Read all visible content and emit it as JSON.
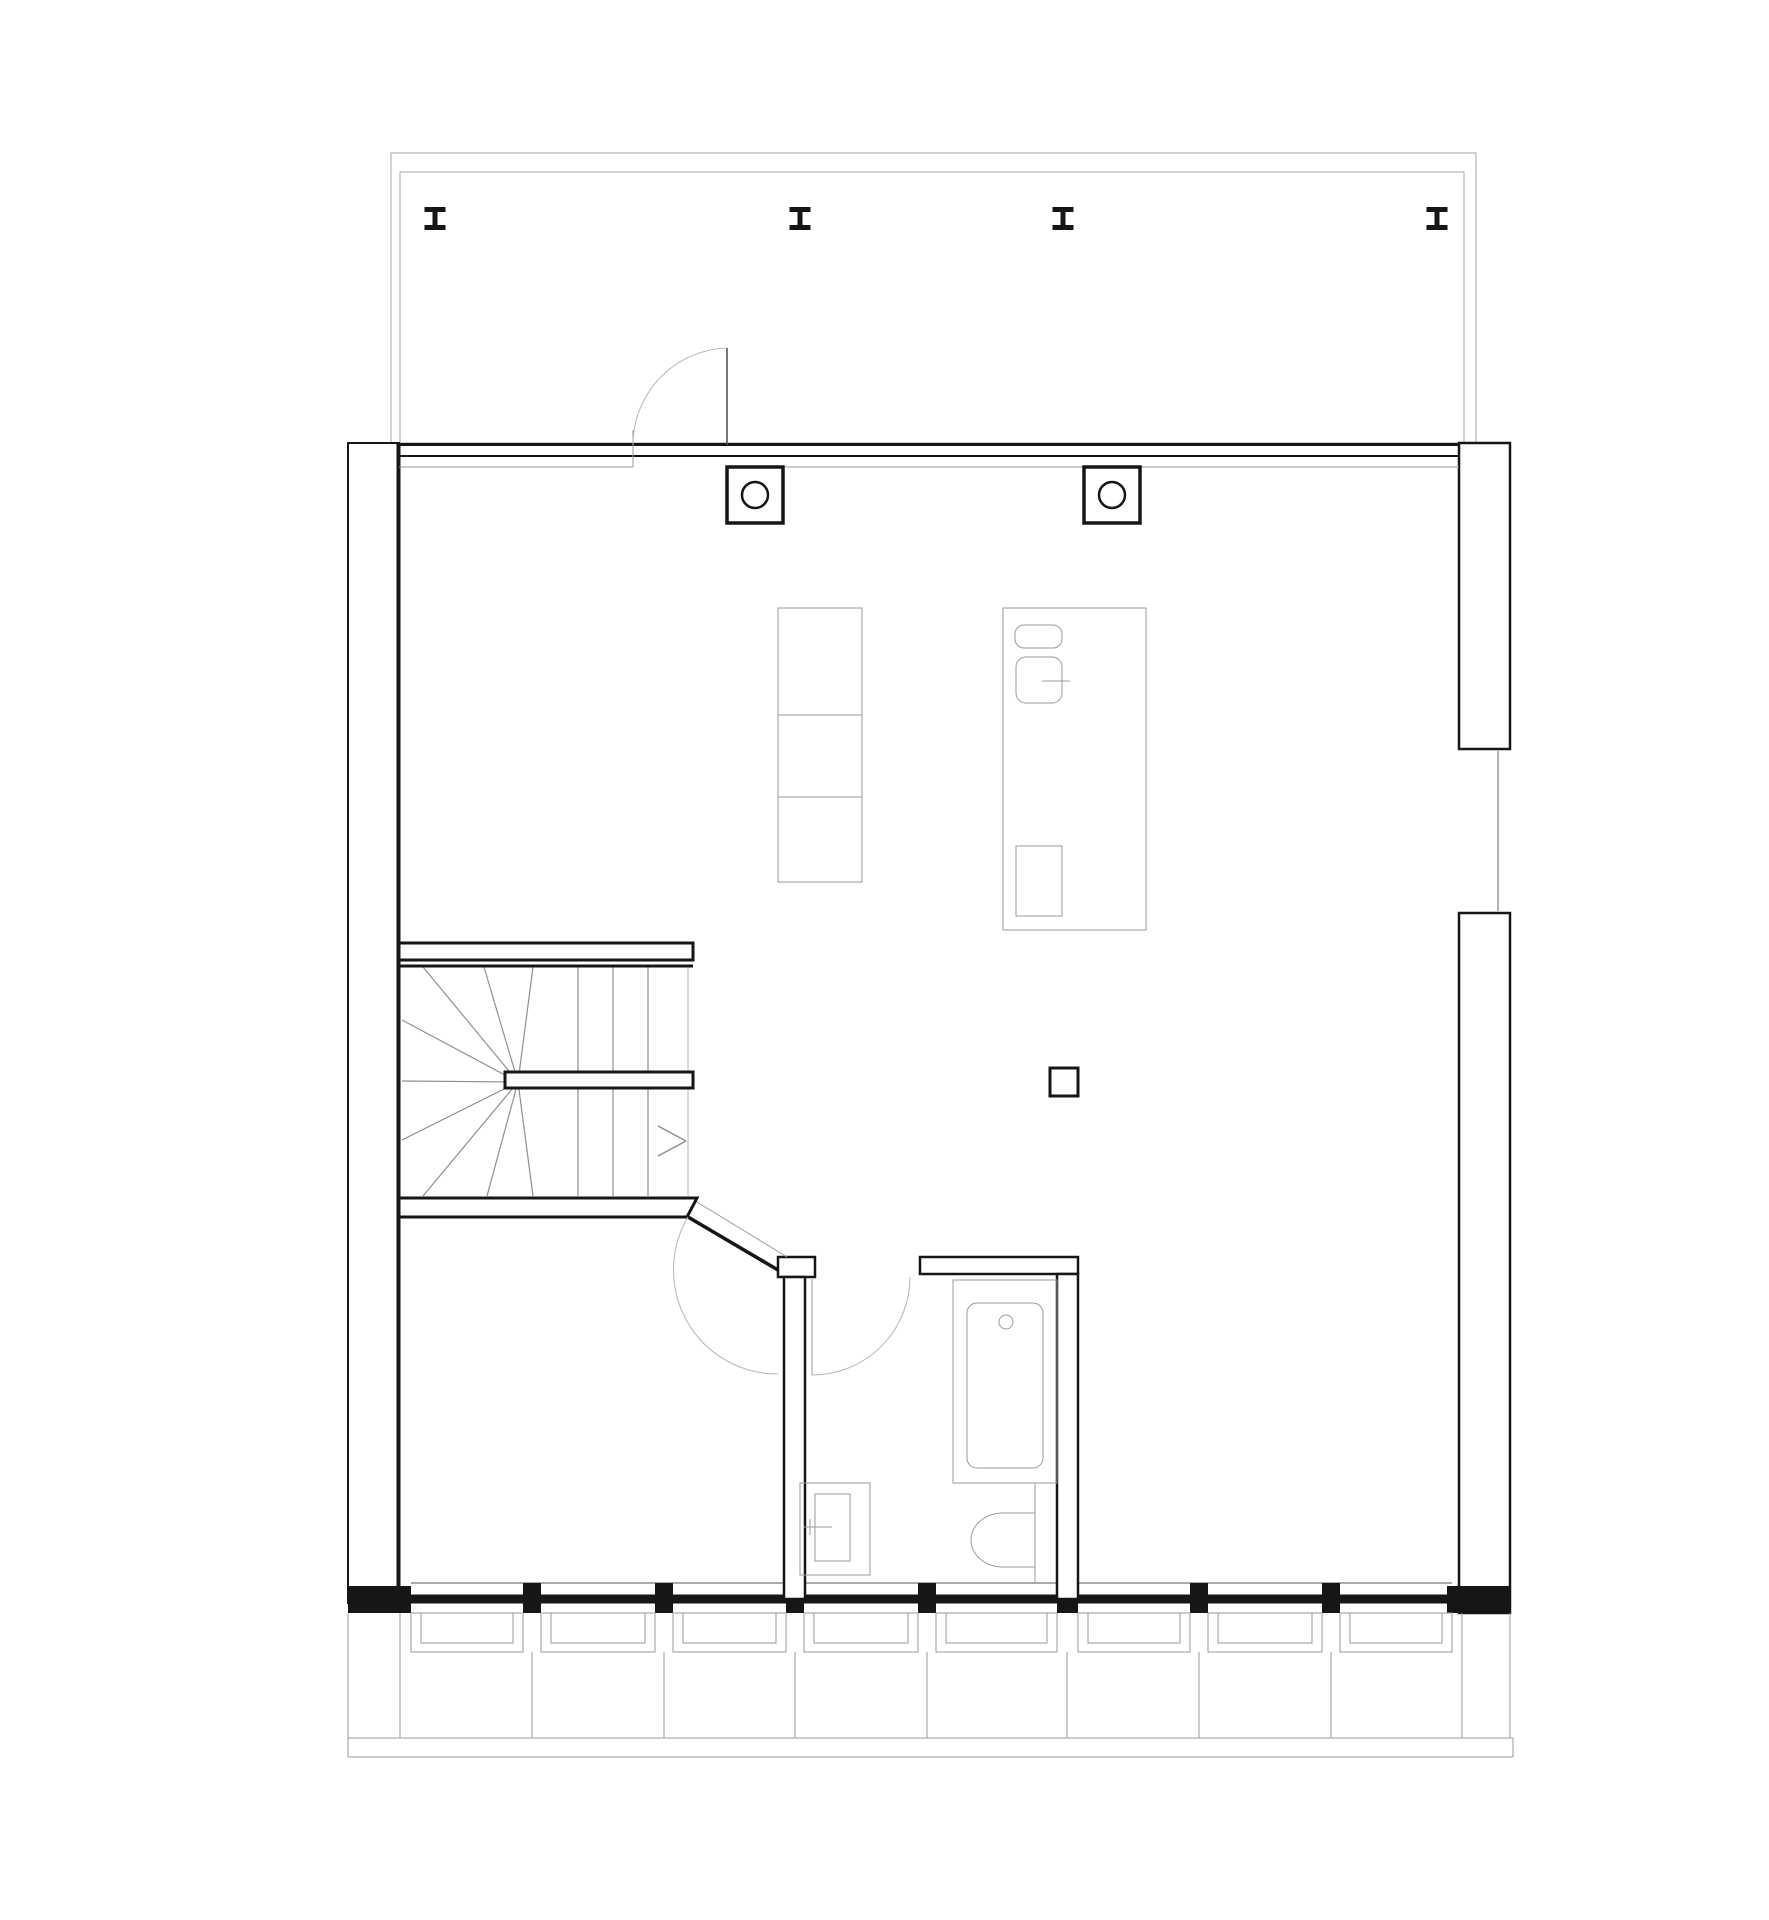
{
  "meta": {
    "description": "architectural floor plan, single storey, no text labels visible",
    "canvas": {
      "w": 1769,
      "h": 1920
    },
    "background": "#ffffff"
  },
  "colors": {
    "wall": "#161616",
    "wall_fill": "#ffffff",
    "light": "#9a9a9a",
    "lighter": "#b5b5b5",
    "tread": "#8f8f8f"
  },
  "terrace": {
    "outer": {
      "x": 391,
      "y": 153,
      "w": 1085,
      "h": 290
    },
    "inner": {
      "x": 400,
      "y": 172,
      "w": 1064,
      "h": 271
    },
    "ibeams": {
      "centers_x": [
        435,
        800,
        1063,
        1437
      ],
      "top_y": 207,
      "w": 21,
      "h": 23,
      "flange": 5,
      "web": 5
    }
  },
  "glazing_front": {
    "line1": {
      "x1": 399,
      "y": 444.5,
      "x2": 1459,
      "sw": 3
    },
    "line2": {
      "x1": 399,
      "y": 456,
      "x2": 1459,
      "sw": 2
    },
    "thin_left": {
      "x1": 399,
      "y": 467,
      "x2": 633
    },
    "thin_right": {
      "x1": 727,
      "y": 467,
      "x2": 1459
    }
  },
  "walls": {
    "left": {
      "x": 348,
      "y": 443,
      "w": 51,
      "h": 1160
    },
    "left_inner": {
      "x": 398.5,
      "y1": 443,
      "y2": 1600,
      "sw": 4
    },
    "right_upper": {
      "x": 1459,
      "y": 443,
      "w": 51,
      "h": 306
    },
    "right_lower": {
      "x": 1459,
      "y": 913,
      "w": 51,
      "h": 700
    },
    "right_window": {
      "glass_x": 1498,
      "y1": 751,
      "y2": 911,
      "cap1_y": 749,
      "cap2_y": 913
    },
    "bottom_band": {
      "x1": 348,
      "x2": 1510,
      "y": 1599,
      "sw": 9
    },
    "bottom_sill": {
      "x1": 411,
      "x2": 1452,
      "y": 1583
    },
    "corner_blocks": [
      {
        "x": 348,
        "y": 1586,
        "w": 63,
        "h": 27
      },
      {
        "x": 1447,
        "y": 1586,
        "w": 63,
        "h": 27
      }
    ]
  },
  "fenestration": {
    "mullions": {
      "xs": [
        523,
        655,
        786,
        918,
        1190,
        1322
      ],
      "y": 1583,
      "w": 18,
      "h": 30
    },
    "extra_mullion": {
      "x": 1057,
      "y": 1583,
      "w": 21,
      "h": 30
    },
    "bays": [
      [
        411,
        523
      ],
      [
        541,
        655
      ],
      [
        673,
        786
      ],
      [
        804,
        918
      ],
      [
        936,
        1057
      ],
      [
        1078,
        1190
      ],
      [
        1208,
        1322
      ],
      [
        1340,
        1452
      ]
    ],
    "frame_top_y": 1613,
    "frame_h": 39,
    "frame_inner_h": 30,
    "frame_inset": 10,
    "drop_edge_xs": [
      348,
      400,
      1462,
      1510
    ],
    "drop_center_xs": [
      532,
      664,
      795,
      927,
      1067,
      1199,
      1331
    ],
    "drop_edge_y1": 1613,
    "drop_center_y1": 1652,
    "drop_y2": 1738,
    "kerb": {
      "x1": 348,
      "x2": 1513,
      "y1": 1738,
      "y2": 1757
    }
  },
  "stairs": {
    "upper_bar": {
      "x": 399,
      "y": 943,
      "w": 294,
      "h": 17
    },
    "top_edge": {
      "x1": 399,
      "y": 966,
      "x2": 693,
      "sw": 3
    },
    "handrail": {
      "x": 505,
      "y": 1072,
      "w": 188,
      "h": 16
    },
    "bottom_bar_points": "399,1198 697,1198 687,1217 399,1217",
    "pivot": {
      "x": 518,
      "y": 1082
    },
    "fan_targets": [
      [
        423,
        967
      ],
      [
        484,
        967
      ],
      [
        533,
        967
      ],
      [
        402,
        1020
      ],
      [
        402,
        1081
      ],
      [
        402,
        1140
      ],
      [
        423,
        1196
      ],
      [
        487,
        1196
      ],
      [
        533,
        1196
      ]
    ],
    "tread_xs": [
      578,
      613,
      648
    ],
    "treads_above": {
      "y1": 967,
      "y2": 1071
    },
    "treads_below": {
      "y1": 1089,
      "y2": 1196
    },
    "edge_line": {
      "x": 688,
      "y1": 967,
      "y2": 1196
    },
    "arrow": [
      [
        658,
        1126,
        686,
        1141
      ],
      [
        686,
        1141,
        658,
        1156
      ]
    ]
  },
  "partitions": {
    "vestibule_cap": {
      "x": 778,
      "y": 1257,
      "w": 37,
      "h": 20
    },
    "vestibule_wall": {
      "x": 784,
      "y": 1277,
      "w": 21,
      "h": 322
    },
    "bath_top_wall": {
      "x": 920,
      "y": 1257,
      "w": 158,
      "h": 17
    },
    "bath_right_wall": {
      "x": 1057,
      "y": 1274,
      "w": 21,
      "h": 325
    }
  },
  "columns": {
    "squares": [
      {
        "x": 727,
        "y": 467
      },
      {
        "x": 1084,
        "y": 467
      }
    ],
    "size": 56,
    "circle_r": 13,
    "duct": {
      "x": 1050,
      "y": 1068,
      "w": 28,
      "h": 28
    }
  },
  "furniture": {
    "stack": {
      "x": 778,
      "y": 608,
      "w": 84,
      "dividers_y": [
        715,
        797
      ],
      "bottom_y": 882
    },
    "island": {
      "x": 1003,
      "y": 608,
      "w": 143,
      "h": 322
    },
    "sink_small": {
      "x": 1015,
      "y": 625,
      "w": 47,
      "h": 23,
      "rx": 9
    },
    "sink_big": {
      "x": 1016,
      "y": 657,
      "w": 46,
      "h": 46,
      "rx": 10
    },
    "faucet": {
      "x1": 1042,
      "y": 681,
      "x2": 1070
    },
    "island_lower_box": {
      "x": 1016,
      "y": 846,
      "w": 46,
      "h": 70
    }
  },
  "bathroom": {
    "tub_platform": {
      "x": 953,
      "y": 1280,
      "w": 104,
      "h": 203
    },
    "tub_inner": {
      "x": 967,
      "y": 1303,
      "w": 76,
      "h": 165,
      "rx": 10
    },
    "tub_drain": {
      "cx": 1006,
      "cy": 1322,
      "r": 7
    },
    "toilet_path": "M1035,1513 L1003,1513 A32,27 0 0 0 1003,1567 L1035,1567 Z",
    "toilet_back_line": {
      "x": 1035,
      "y1": 1483,
      "y2": 1583
    },
    "basin_outer": {
      "x": 800,
      "y": 1483,
      "w": 70,
      "h": 92
    },
    "basin_inner": {
      "x": 815,
      "y": 1494,
      "w": 35,
      "h": 67
    },
    "basin_faucet_h": {
      "x1": 804,
      "y": 1527,
      "x2": 832
    },
    "basin_faucet_v": {
      "x": 810,
      "y1": 1519,
      "y2": 1535
    }
  },
  "doors": {
    "terrace_door": {
      "leaf": {
        "x": 727,
        "y1": 348,
        "y2": 445
      },
      "arc": "M633,445 A97,97 0 0 1 727,348",
      "jamb": {
        "x": 633,
        "y1": 430,
        "y2": 467
      }
    },
    "bedroom_door": {
      "frame_line": {
        "x1": 697,
        "y1": 1202,
        "x2": 787,
        "y2": 1257
      },
      "leaf": {
        "x1": 688,
        "y1": 1217,
        "x2": 778,
        "y2": 1270
      },
      "arc": "M688,1217 A104,104 0 0 0 778,1374"
    },
    "bath_door": {
      "leaf": {
        "x": 812,
        "y1": 1279,
        "y2": 1375
      },
      "arc": "M812,1375 A98,98 0 0 0 910,1277"
    }
  }
}
